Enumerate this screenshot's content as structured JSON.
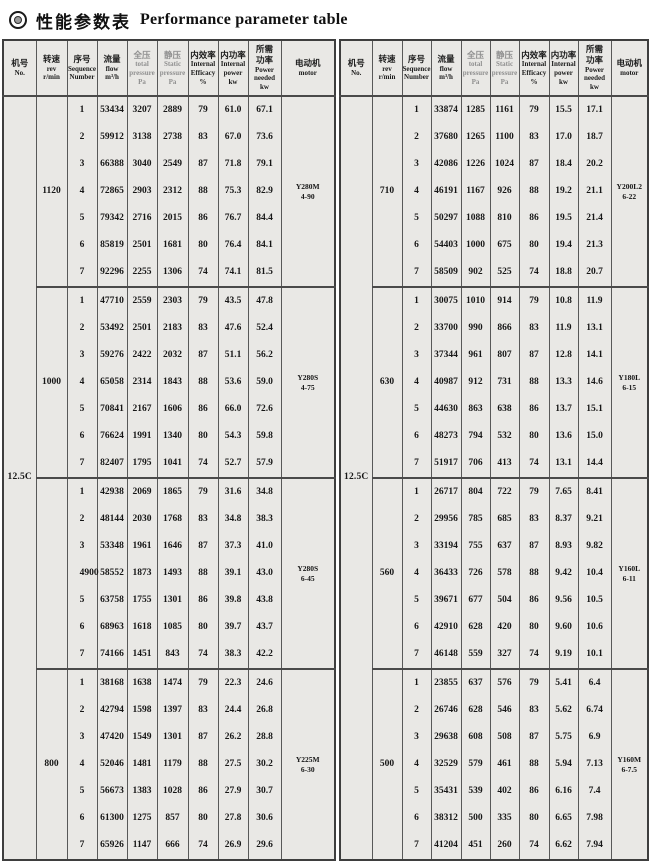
{
  "page": {
    "title_cn": "性能参数表",
    "title_en": "Performance parameter table"
  },
  "colors": {
    "cell_bg": "#e9e8e5",
    "border": "#4a4a4a",
    "text": "#161616",
    "muted_header_text": "#8f8f8f",
    "page_bg": "#ffffff"
  },
  "header_labels": {
    "no": [
      "机号",
      "No."
    ],
    "rev": [
      "转速",
      "rev",
      "r/min"
    ],
    "seq": [
      "序号",
      "Sequence",
      "Number"
    ],
    "flow": [
      "流量",
      "flow",
      "m³/h"
    ],
    "total_pressure": [
      "全压",
      "total",
      "pressure",
      "Pa"
    ],
    "static_pressure": [
      "静压",
      "Static",
      "pressure",
      "Pa"
    ],
    "efficiency": [
      "内效率",
      "Internal",
      "Efficacy",
      "%"
    ],
    "internal_power": [
      "内功率",
      "Internal",
      "power",
      "kw"
    ],
    "power_needed": [
      "所需",
      "功率",
      "Power",
      "needed",
      "kw"
    ],
    "motor": [
      "电动机",
      "motor"
    ]
  },
  "tables": [
    {
      "side": "left",
      "no": "12.5C",
      "blocks": [
        {
          "rev": "1120",
          "motor": {
            "model": "Y280M",
            "spec": "4-90"
          },
          "rows": [
            {
              "seq": "1",
              "flow": "53434",
              "total": "3207",
              "static": "2889",
              "eff": "79",
              "ipow": "61.0",
              "need": "67.1"
            },
            {
              "seq": "2",
              "flow": "59912",
              "total": "3138",
              "static": "2738",
              "eff": "83",
              "ipow": "67.0",
              "need": "73.6"
            },
            {
              "seq": "3",
              "flow": "66388",
              "total": "3040",
              "static": "2549",
              "eff": "87",
              "ipow": "71.8",
              "need": "79.1"
            },
            {
              "seq": "4",
              "flow": "72865",
              "total": "2903",
              "static": "2312",
              "eff": "88",
              "ipow": "75.3",
              "need": "82.9"
            },
            {
              "seq": "5",
              "flow": "79342",
              "total": "2716",
              "static": "2015",
              "eff": "86",
              "ipow": "76.7",
              "need": "84.4"
            },
            {
              "seq": "6",
              "flow": "85819",
              "total": "2501",
              "static": "1681",
              "eff": "80",
              "ipow": "76.4",
              "need": "84.1"
            },
            {
              "seq": "7",
              "flow": "92296",
              "total": "2255",
              "static": "1306",
              "eff": "74",
              "ipow": "74.1",
              "need": "81.5"
            }
          ]
        },
        {
          "rev": "1000",
          "motor": {
            "model": "Y280S",
            "spec": "4-75"
          },
          "rows": [
            {
              "seq": "1",
              "flow": "47710",
              "total": "2559",
              "static": "2303",
              "eff": "79",
              "ipow": "43.5",
              "need": "47.8"
            },
            {
              "seq": "2",
              "flow": "53492",
              "total": "2501",
              "static": "2183",
              "eff": "83",
              "ipow": "47.6",
              "need": "52.4"
            },
            {
              "seq": "3",
              "flow": "59276",
              "total": "2422",
              "static": "2032",
              "eff": "87",
              "ipow": "51.1",
              "need": "56.2"
            },
            {
              "seq": "4",
              "flow": "65058",
              "total": "2314",
              "static": "1843",
              "eff": "88",
              "ipow": "53.6",
              "need": "59.0"
            },
            {
              "seq": "5",
              "flow": "70841",
              "total": "2167",
              "static": "1606",
              "eff": "86",
              "ipow": "66.0",
              "need": "72.6"
            },
            {
              "seq": "6",
              "flow": "76624",
              "total": "1991",
              "static": "1340",
              "eff": "80",
              "ipow": "54.3",
              "need": "59.8"
            },
            {
              "seq": "7",
              "flow": "82407",
              "total": "1795",
              "static": "1041",
              "eff": "74",
              "ipow": "52.7",
              "need": "57.9"
            }
          ]
        },
        {
          "rev": "900",
          "rev_shifted": true,
          "motor": {
            "model": "Y280S",
            "spec": "6-45"
          },
          "rows": [
            {
              "seq": "1",
              "flow": "42938",
              "total": "2069",
              "static": "1865",
              "eff": "79",
              "ipow": "31.6",
              "need": "34.8"
            },
            {
              "seq": "2",
              "flow": "48144",
              "total": "2030",
              "static": "1768",
              "eff": "83",
              "ipow": "34.8",
              "need": "38.3"
            },
            {
              "seq": "3",
              "flow": "53348",
              "total": "1961",
              "static": "1646",
              "eff": "87",
              "ipow": "37.3",
              "need": "41.0"
            },
            {
              "seq": "4",
              "flow": "58552",
              "total": "1873",
              "static": "1493",
              "eff": "88",
              "ipow": "39.1",
              "need": "43.0"
            },
            {
              "seq": "5",
              "flow": "63758",
              "total": "1755",
              "static": "1301",
              "eff": "86",
              "ipow": "39.8",
              "need": "43.8"
            },
            {
              "seq": "6",
              "flow": "68963",
              "total": "1618",
              "static": "1085",
              "eff": "80",
              "ipow": "39.7",
              "need": "43.7"
            },
            {
              "seq": "7",
              "flow": "74166",
              "total": "1451",
              "static": "843",
              "eff": "74",
              "ipow": "38.3",
              "need": "42.2"
            }
          ]
        },
        {
          "rev": "800",
          "motor": {
            "model": "Y225M",
            "spec": "6-30"
          },
          "rows": [
            {
              "seq": "1",
              "flow": "38168",
              "total": "1638",
              "static": "1474",
              "eff": "79",
              "ipow": "22.3",
              "need": "24.6"
            },
            {
              "seq": "2",
              "flow": "42794",
              "total": "1598",
              "static": "1397",
              "eff": "83",
              "ipow": "24.4",
              "need": "26.8"
            },
            {
              "seq": "3",
              "flow": "47420",
              "total": "1549",
              "static": "1301",
              "eff": "87",
              "ipow": "26.2",
              "need": "28.8"
            },
            {
              "seq": "4",
              "flow": "52046",
              "total": "1481",
              "static": "1179",
              "eff": "88",
              "ipow": "27.5",
              "need": "30.2"
            },
            {
              "seq": "5",
              "flow": "56673",
              "total": "1383",
              "static": "1028",
              "eff": "86",
              "ipow": "27.9",
              "need": "30.7"
            },
            {
              "seq": "6",
              "flow": "61300",
              "total": "1275",
              "static": "857",
              "eff": "80",
              "ipow": "27.8",
              "need": "30.6"
            },
            {
              "seq": "7",
              "flow": "65926",
              "total": "1147",
              "static": "666",
              "eff": "74",
              "ipow": "26.9",
              "need": "29.6"
            }
          ]
        }
      ]
    },
    {
      "side": "right",
      "no": "12.5C",
      "blocks": [
        {
          "rev": "710",
          "motor": {
            "model": "Y200L2",
            "spec": "6-22"
          },
          "rows": [
            {
              "seq": "1",
              "flow": "33874",
              "total": "1285",
              "static": "1161",
              "eff": "79",
              "ipow": "15.5",
              "need": "17.1"
            },
            {
              "seq": "2",
              "flow": "37680",
              "total": "1265",
              "static": "1100",
              "eff": "83",
              "ipow": "17.0",
              "need": "18.7"
            },
            {
              "seq": "3",
              "flow": "42086",
              "total": "1226",
              "static": "1024",
              "eff": "87",
              "ipow": "18.4",
              "need": "20.2"
            },
            {
              "seq": "4",
              "flow": "46191",
              "total": "1167",
              "static": "926",
              "eff": "88",
              "ipow": "19.2",
              "need": "21.1"
            },
            {
              "seq": "5",
              "flow": "50297",
              "total": "1088",
              "static": "810",
              "eff": "86",
              "ipow": "19.5",
              "need": "21.4"
            },
            {
              "seq": "6",
              "flow": "54403",
              "total": "1000",
              "static": "675",
              "eff": "80",
              "ipow": "19.4",
              "need": "21.3"
            },
            {
              "seq": "7",
              "flow": "58509",
              "total": "902",
              "static": "525",
              "eff": "74",
              "ipow": "18.8",
              "need": "20.7"
            }
          ]
        },
        {
          "rev": "630",
          "motor": {
            "model": "Y180L",
            "spec": "6-15"
          },
          "rows": [
            {
              "seq": "1",
              "flow": "30075",
              "total": "1010",
              "static": "914",
              "eff": "79",
              "ipow": "10.8",
              "need": "11.9"
            },
            {
              "seq": "2",
              "flow": "33700",
              "total": "990",
              "static": "866",
              "eff": "83",
              "ipow": "11.9",
              "need": "13.1"
            },
            {
              "seq": "3",
              "flow": "37344",
              "total": "961",
              "static": "807",
              "eff": "87",
              "ipow": "12.8",
              "need": "14.1"
            },
            {
              "seq": "4",
              "flow": "40987",
              "total": "912",
              "static": "731",
              "eff": "88",
              "ipow": "13.3",
              "need": "14.6"
            },
            {
              "seq": "5",
              "flow": "44630",
              "total": "863",
              "static": "638",
              "eff": "86",
              "ipow": "13.7",
              "need": "15.1"
            },
            {
              "seq": "6",
              "flow": "48273",
              "total": "794",
              "static": "532",
              "eff": "80",
              "ipow": "13.6",
              "need": "15.0"
            },
            {
              "seq": "7",
              "flow": "51917",
              "total": "706",
              "static": "413",
              "eff": "74",
              "ipow": "13.1",
              "need": "14.4"
            }
          ]
        },
        {
          "rev": "560",
          "motor": {
            "model": "Y160L",
            "spec": "6-11"
          },
          "rows": [
            {
              "seq": "1",
              "flow": "26717",
              "total": "804",
              "static": "722",
              "eff": "79",
              "ipow": "7.65",
              "need": "8.41"
            },
            {
              "seq": "2",
              "flow": "29956",
              "total": "785",
              "static": "685",
              "eff": "83",
              "ipow": "8.37",
              "need": "9.21"
            },
            {
              "seq": "3",
              "flow": "33194",
              "total": "755",
              "static": "637",
              "eff": "87",
              "ipow": "8.93",
              "need": "9.82"
            },
            {
              "seq": "4",
              "flow": "36433",
              "total": "726",
              "static": "578",
              "eff": "88",
              "ipow": "9.42",
              "need": "10.4"
            },
            {
              "seq": "5",
              "flow": "39671",
              "total": "677",
              "static": "504",
              "eff": "86",
              "ipow": "9.56",
              "need": "10.5"
            },
            {
              "seq": "6",
              "flow": "42910",
              "total": "628",
              "static": "420",
              "eff": "80",
              "ipow": "9.60",
              "need": "10.6"
            },
            {
              "seq": "7",
              "flow": "46148",
              "total": "559",
              "static": "327",
              "eff": "74",
              "ipow": "9.19",
              "need": "10.1"
            }
          ]
        },
        {
          "rev": "500",
          "motor": {
            "model": "Y160M",
            "spec": "6-7.5"
          },
          "rows": [
            {
              "seq": "1",
              "flow": "23855",
              "total": "637",
              "static": "576",
              "eff": "79",
              "ipow": "5.41",
              "need": "6.4"
            },
            {
              "seq": "2",
              "flow": "26746",
              "total": "628",
              "static": "546",
              "eff": "83",
              "ipow": "5.62",
              "need": "6.74"
            },
            {
              "seq": "3",
              "flow": "29638",
              "total": "608",
              "static": "508",
              "eff": "87",
              "ipow": "5.75",
              "need": "6.9"
            },
            {
              "seq": "4",
              "flow": "32529",
              "total": "579",
              "static": "461",
              "eff": "88",
              "ipow": "5.94",
              "need": "7.13"
            },
            {
              "seq": "5",
              "flow": "35431",
              "total": "539",
              "static": "402",
              "eff": "86",
              "ipow": "6.16",
              "need": "7.4"
            },
            {
              "seq": "6",
              "flow": "38312",
              "total": "500",
              "static": "335",
              "eff": "80",
              "ipow": "6.65",
              "need": "7.98"
            },
            {
              "seq": "7",
              "flow": "41204",
              "total": "451",
              "static": "260",
              "eff": "74",
              "ipow": "6.62",
              "need": "7.94"
            }
          ]
        }
      ]
    }
  ]
}
